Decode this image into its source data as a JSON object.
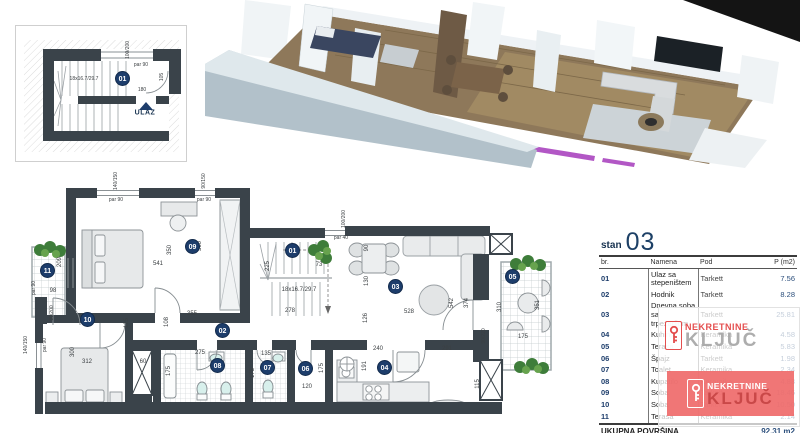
{
  "colors": {
    "wall": "#3a434a",
    "accent_navy": "#1d3d6b",
    "brand_red": "#e23b3b",
    "brand_gray": "#a5a5a5",
    "watermark_box": "#ee6767",
    "render_wall_blue": "#b2c1ca",
    "render_floor_wood": "#8e785a",
    "render_accent_purple": "#b257c5"
  },
  "plan": {
    "markers": [
      {
        "n": "01",
        "x": 123,
        "y": 79
      },
      {
        "n": "09",
        "x": 193,
        "y": 247
      },
      {
        "n": "01",
        "x": 293,
        "y": 251
      },
      {
        "n": "03",
        "x": 396,
        "y": 287
      },
      {
        "n": "05",
        "x": 513,
        "y": 277
      },
      {
        "n": "11",
        "x": 48,
        "y": 271
      },
      {
        "n": "10",
        "x": 88,
        "y": 320
      },
      {
        "n": "02",
        "x": 223,
        "y": 331
      },
      {
        "n": "08",
        "x": 218,
        "y": 366
      },
      {
        "n": "07",
        "x": 268,
        "y": 368
      },
      {
        "n": "06",
        "x": 306,
        "y": 369
      },
      {
        "n": "04",
        "x": 385,
        "y": 368
      }
    ],
    "labels": [
      {
        "t": "100/200",
        "x": 128,
        "y": 50,
        "r": -90,
        "s": 5
      },
      {
        "t": "par 90",
        "x": 141,
        "y": 65,
        "s": 5
      },
      {
        "t": "18x16.7/29.7",
        "x": 84,
        "y": 79,
        "s": 5
      },
      {
        "t": "180",
        "x": 142,
        "y": 90,
        "s": 5
      },
      {
        "t": "105",
        "x": 162,
        "y": 77,
        "r": -90,
        "s": 5
      },
      {
        "t": "ULAZ",
        "x": 145,
        "y": 113,
        "s": 7,
        "c": "ulaz"
      },
      {
        "t": "140/150",
        "x": 116,
        "y": 181,
        "r": -90,
        "s": 5
      },
      {
        "t": "par 90",
        "x": 116,
        "y": 200,
        "s": 5
      },
      {
        "t": "90/150",
        "x": 204,
        "y": 181,
        "r": -90,
        "s": 5
      },
      {
        "t": "par 90",
        "x": 204,
        "y": 200,
        "s": 5
      },
      {
        "t": "100/200",
        "x": 344,
        "y": 219,
        "r": -90,
        "s": 5
      },
      {
        "t": "par 40",
        "x": 341,
        "y": 238,
        "s": 5
      },
      {
        "t": "350",
        "x": 170,
        "y": 250,
        "r": -90
      },
      {
        "t": "300",
        "x": 200,
        "y": 246,
        "r": -90
      },
      {
        "t": "541",
        "x": 158,
        "y": 264
      },
      {
        "t": "209",
        "x": 60,
        "y": 262,
        "r": -90
      },
      {
        "t": "98",
        "x": 53,
        "y": 291
      },
      {
        "t": "80/200",
        "x": 52,
        "y": 313,
        "r": -90,
        "s": 5
      },
      {
        "t": "par 90",
        "x": 34,
        "y": 288,
        "r": -90,
        "s": 5
      },
      {
        "t": "225",
        "x": 268,
        "y": 266,
        "r": -90
      },
      {
        "t": "73",
        "x": 319,
        "y": 265
      },
      {
        "t": "18x16.7/29.7",
        "x": 299,
        "y": 290,
        "s": 6
      },
      {
        "t": "90",
        "x": 367,
        "y": 248,
        "r": -90
      },
      {
        "t": "130",
        "x": 367,
        "y": 281,
        "r": -90
      },
      {
        "t": "355",
        "x": 192,
        "y": 314
      },
      {
        "t": "278",
        "x": 290,
        "y": 311
      },
      {
        "t": "528",
        "x": 409,
        "y": 312
      },
      {
        "t": "108",
        "x": 167,
        "y": 322,
        "r": -90
      },
      {
        "t": "126",
        "x": 366,
        "y": 318,
        "r": -90
      },
      {
        "t": "125",
        "x": 127,
        "y": 323,
        "r": -90
      },
      {
        "t": "542",
        "x": 452,
        "y": 303,
        "r": -90
      },
      {
        "t": "374",
        "x": 467,
        "y": 303,
        "r": -90
      },
      {
        "t": "310",
        "x": 500,
        "y": 307,
        "r": -90
      },
      {
        "t": "351",
        "x": 538,
        "y": 305,
        "r": -90
      },
      {
        "t": "90/220",
        "x": 484,
        "y": 336,
        "r": -90,
        "s": 5
      },
      {
        "t": "175",
        "x": 523,
        "y": 337
      },
      {
        "t": "240",
        "x": 378,
        "y": 349
      },
      {
        "t": "291",
        "x": 447,
        "y": 349
      },
      {
        "t": "191",
        "x": 365,
        "y": 366,
        "r": -90
      },
      {
        "t": "115",
        "x": 478,
        "y": 384,
        "r": -90
      },
      {
        "t": "275",
        "x": 200,
        "y": 353
      },
      {
        "t": "175",
        "x": 169,
        "y": 371,
        "r": -90
      },
      {
        "t": "135",
        "x": 266,
        "y": 354
      },
      {
        "t": "175",
        "x": 253,
        "y": 373,
        "r": -90
      },
      {
        "t": "120",
        "x": 307,
        "y": 387
      },
      {
        "t": "175",
        "x": 322,
        "y": 368,
        "r": -90
      },
      {
        "t": "60",
        "x": 143,
        "y": 362
      },
      {
        "t": "312",
        "x": 87,
        "y": 362
      },
      {
        "t": "300",
        "x": 73,
        "y": 352,
        "r": -90
      },
      {
        "t": "140/150",
        "x": 26,
        "y": 345,
        "r": -90,
        "s": 5
      },
      {
        "t": "par 90",
        "x": 45,
        "y": 345,
        "r": -90,
        "s": 5
      }
    ]
  },
  "table": {
    "title_prefix": "stan",
    "title_number": "03",
    "headers": [
      "br.",
      "Namena",
      "Pod",
      "P (m2)"
    ],
    "rows": [
      [
        "01",
        "Ulaz sa stepeništem",
        "Tarkett",
        "7.56"
      ],
      [
        "02",
        "Hodnik",
        "Tarkett",
        "8.28"
      ],
      [
        "03",
        "Dnevna soba sa trpezarijom",
        "Tarkett",
        "25.81"
      ],
      [
        "04",
        "Kuhinja",
        "Keramika",
        "4.58"
      ],
      [
        "05",
        "Terasa",
        "Keramika",
        "5.83"
      ],
      [
        "06",
        "Špajz",
        "Tarkett",
        "1.98"
      ],
      [
        "07",
        "Toalet",
        "Keramika",
        "2.34"
      ],
      [
        "08",
        "Kupatilo",
        "Keramika",
        "4.83"
      ],
      [
        "09",
        "Soba",
        "Tarkett",
        "18.46"
      ],
      [
        "10",
        "Soba",
        "Tarkett",
        "10.50"
      ],
      [
        "11",
        "Terasa",
        "Keramika",
        "2.14"
      ]
    ],
    "footer_label": "UKUPNA POVRŠINA",
    "footer_value": "92.31 m2"
  },
  "watermark": {
    "line1": "NEKRETNINE",
    "line2": "KLJUČ"
  }
}
